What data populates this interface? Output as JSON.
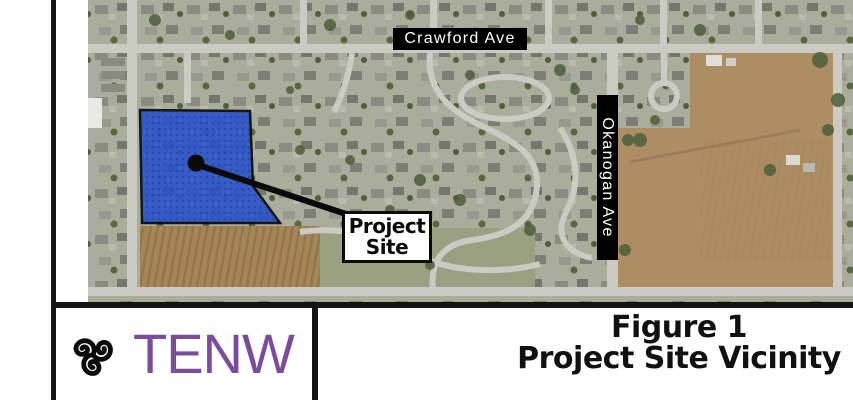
{
  "map": {
    "crawford_ave_label": "Crawford Ave",
    "okanogan_ave_label": "Okanogan Ave",
    "project_site_callout": {
      "line1": "Project",
      "line2": "Site"
    },
    "site_fill_color": "#2e55c9",
    "label_background": "#000000",
    "label_text": "#ffffff"
  },
  "title_block": {
    "logo_text": "TENW",
    "logo_icon": "triskelion-icon",
    "logo_color": "#7b4c9c",
    "figure_number": "Figure 1",
    "figure_title": "Project Site Vicinity"
  }
}
